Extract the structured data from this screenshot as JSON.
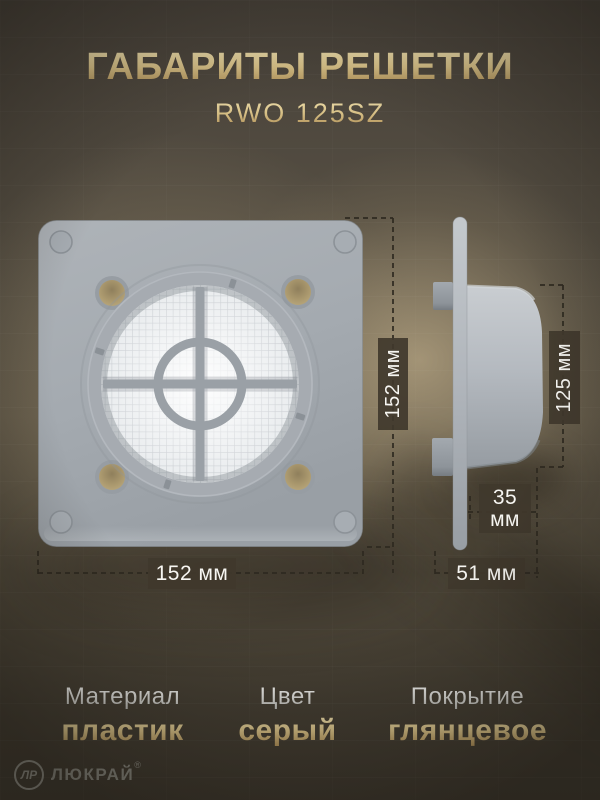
{
  "header": {
    "title": "ГАБАРИТЫ РЕШЕТКИ",
    "model": "RWO 125SZ"
  },
  "dimensions": {
    "front_height": "152 мм",
    "front_width": "152 мм",
    "duct_diameter": "125 мм",
    "duct_depth_value": "35",
    "duct_depth_unit": "мм",
    "total_depth": "51 мм"
  },
  "specs": [
    {
      "label": "Материал",
      "value": "пластик"
    },
    {
      "label": "Цвет",
      "value": "серый"
    },
    {
      "label": "Покрытие",
      "value": "глянцевое"
    }
  ],
  "brand": {
    "monogram": "ЛР",
    "name": "ЛЮКРАЙ",
    "registered": "®"
  },
  "colors": {
    "accent_gold": "#cdb376",
    "badge_background": "#40382c",
    "plate_gray": "#a6abb1",
    "hole_tan": "#b19f75",
    "mesh_white": "#eef0f2",
    "background_brown": "#4a4337",
    "dash_line": "#2e2920"
  }
}
